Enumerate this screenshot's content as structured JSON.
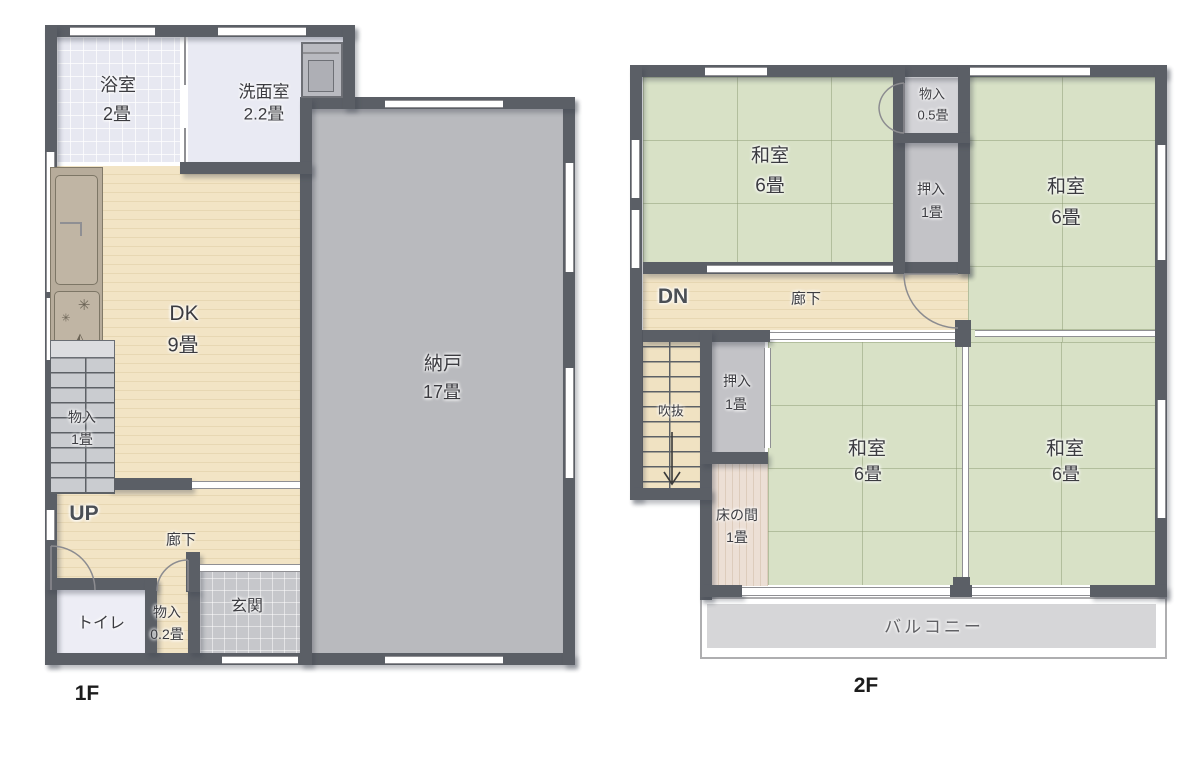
{
  "f1": {
    "floor_label": "1F",
    "bath": {
      "name": "浴室",
      "size": "2畳"
    },
    "washroom": {
      "name": "洗面室",
      "size": "2.2畳"
    },
    "dk": {
      "name": "DK",
      "size": "9畳"
    },
    "storage": {
      "name": "納戸",
      "size": "17畳"
    },
    "under_stairs_closet": {
      "name": "物入",
      "size": "1畳"
    },
    "stairs_up": "UP",
    "corridor": "廊下",
    "toilet": "トイレ",
    "entry_closet": {
      "name": "物入",
      "size": "0.2畳"
    },
    "entrance": "玄関"
  },
  "f2": {
    "floor_label": "2F",
    "washitsu_nw": {
      "name": "和室",
      "size": "6畳"
    },
    "storage_small": {
      "name": "物入",
      "size": "0.5畳"
    },
    "oshiire_north": {
      "name": "押入",
      "size": "1畳"
    },
    "washitsu_ne": {
      "name": "和室",
      "size": "6畳"
    },
    "stairs_down": "DN",
    "corridor": "廊下",
    "atrium": "吹抜",
    "oshiire_center": {
      "name": "押入",
      "size": "1畳"
    },
    "tokonoma": {
      "name": "床の間",
      "size": "1畳"
    },
    "washitsu_sw": {
      "name": "和室",
      "size": "6畳"
    },
    "washitsu_se": {
      "name": "和室",
      "size": "6畳"
    },
    "balcony": "バルコニー"
  }
}
